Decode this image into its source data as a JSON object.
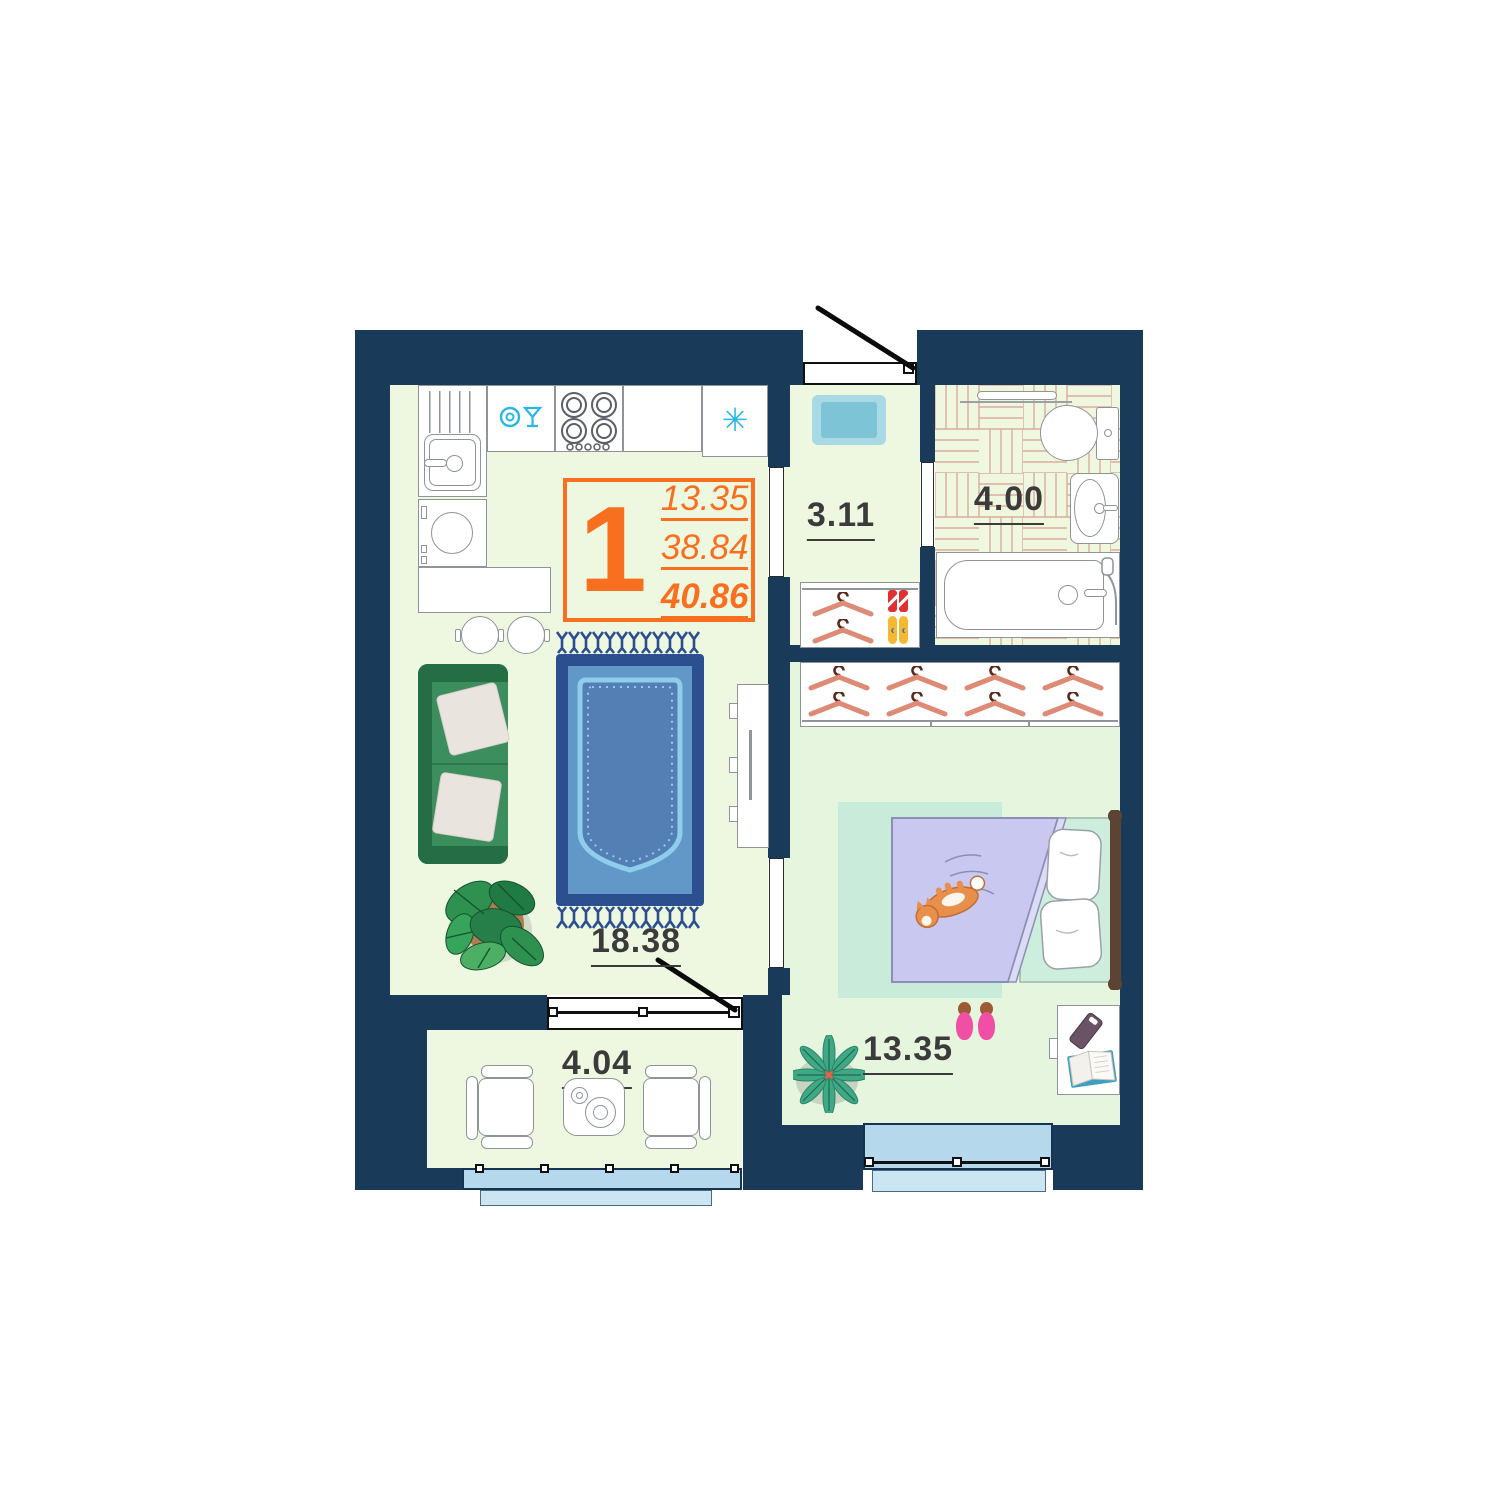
{
  "meta": {
    "type": "apartment-floor-plan",
    "rooms": "1"
  },
  "info_box": {
    "rooms_count": "1",
    "living_area": "13.35",
    "area_without_balcony": "38.84",
    "area_total": "40.86"
  },
  "room_labels": {
    "kitchen_living": "18.38",
    "hallway": "3.11",
    "bathroom": "4.00",
    "bedroom": "13.35",
    "balcony": "4.04"
  },
  "icons": {
    "fridge_snowflake": "✳",
    "dishwasher_icon": "plate-and-wine-glass",
    "hanger_icon": "clothes-hanger",
    "flipflop_strap": "‹"
  },
  "counts": {
    "closet_hangers": 2,
    "wardrobe_hangers": 8,
    "stove_burners": 4
  },
  "colors": {
    "wall": "#1A3A5A",
    "accent_orange": "#F8701F",
    "floor_light": "#EEF8E1",
    "floor_bedroom": "#E6F5DD",
    "window_glass": "#B5D8EC",
    "window_sill": "#CBE5F3",
    "rug_border": "#2C4F90",
    "rug_field": "#6298C8",
    "rug_inner": "#537FB4",
    "rug_lace": "#8ECDEB",
    "sofa_green": "#2E8052",
    "sofa_dark": "#256E45",
    "bed_blanket": "#C9C8F0",
    "bed_sheet": "#CDEEDD",
    "headboard": "#5D4333",
    "cat_orange": "#E98F4C",
    "hanger_arm": "#DD8B74",
    "icon_cyan": "#2AB7E8",
    "parquet_line": "#D9ACA0",
    "label_text": "#3B3B3B"
  }
}
